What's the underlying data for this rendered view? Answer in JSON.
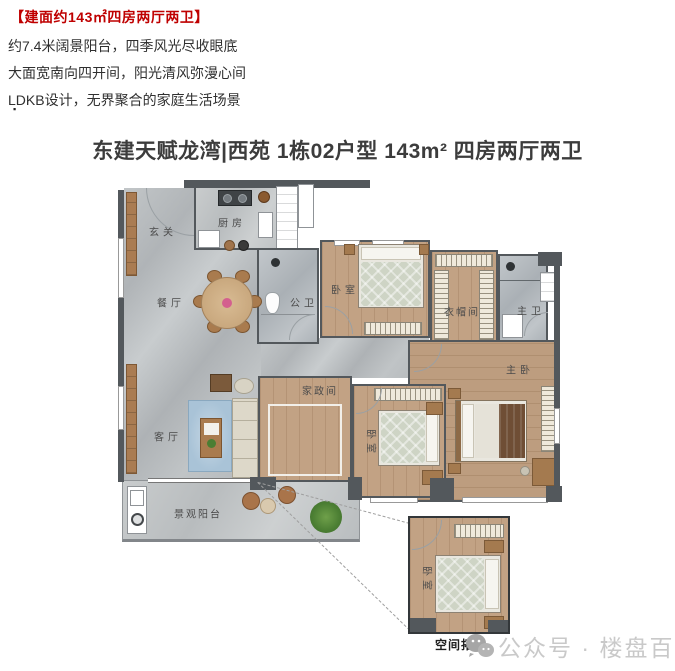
{
  "header": {
    "highlight": "【建面约143㎡四房两厅两卫】",
    "line1": "约7.4米阔景阳台，四季风光尽收眼底",
    "line2": "大面宽南向四开间，阳光清风弥漫心间",
    "line3": "LDKB设计，无界聚合的家庭生活场景",
    "bullet": "▪",
    "highlight_color": "#bf0000"
  },
  "title": "东建天赋龙湾|西苑 1栋02户型 143m² 四房两厅两卫",
  "floorplan": {
    "rooms": {
      "entry": "玄关",
      "kitchen": "厨房",
      "dining": "餐厅",
      "guest_bath": "公卫",
      "bedroom2": "卧室",
      "closet": "衣帽间",
      "master_bath": "主卫",
      "master_bedroom": "主卧",
      "living": "客厅",
      "utility": "家政间",
      "bedroom3": "卧室",
      "balcony": "景观阳台"
    },
    "inset": {
      "room": "卧室",
      "caption": "空间拓展"
    }
  },
  "watermark": {
    "icon": "wechat-icon",
    "text": "公众号 · 楼盘百科"
  },
  "colors": {
    "highlight": "#bf0000",
    "wall": "#53585c",
    "wood_floor": "#c2a284",
    "marble_floor": "#b7bbbd",
    "watermark": "#c9c9c9"
  }
}
